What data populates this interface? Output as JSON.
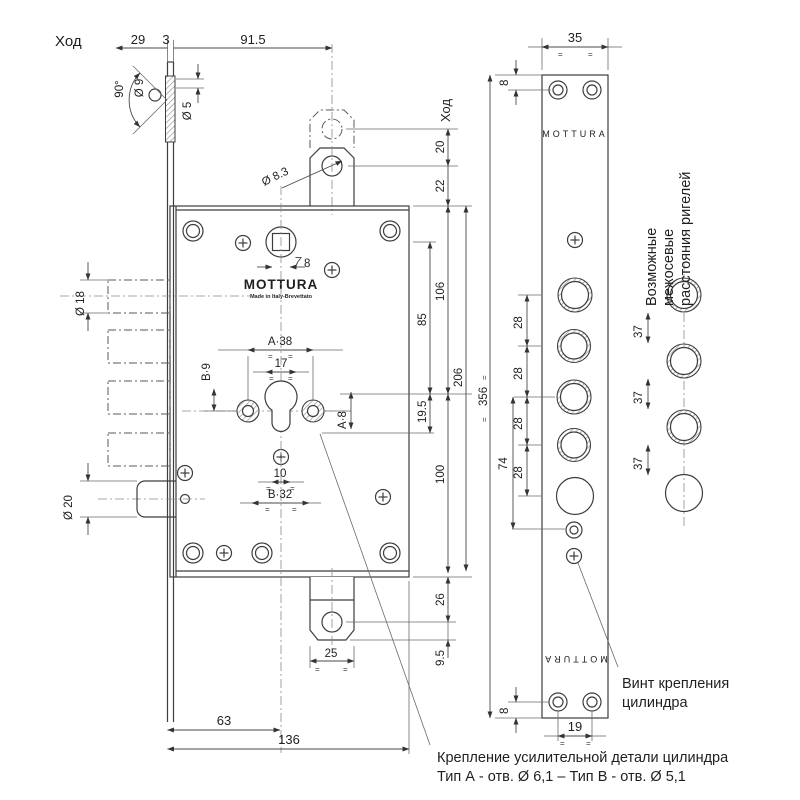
{
  "drawing": {
    "brand": {
      "name": "MOTTURA",
      "sub": "Made in Italy-Brevettato"
    },
    "faceplate": {
      "brand_top": "MOTTURA",
      "brand_bottom": "MOTTURA"
    },
    "labels": {
      "travel_top": "Ход",
      "travel_right": "Ход"
    },
    "dims": {
      "d29": "29",
      "d3": "3",
      "d91_5": "91.5",
      "a90": "90°",
      "dia9": "Ø 9",
      "dia5": "Ø 5",
      "dia8_3": "Ø 8.3",
      "dia18": "Ø 18",
      "dia20": "Ø 20",
      "sq7": "7",
      "sq8": "8",
      "a38": "A·38",
      "d17": "17",
      "b9": "B·9",
      "a8": "A·8",
      "d10": "10",
      "b32": "B·32",
      "d20": "20",
      "d22": "22",
      "d106": "106",
      "d85": "85",
      "d206": "206",
      "d19_5": "19.5",
      "d100": "100",
      "d26": "26",
      "d9_5": "9.5",
      "d25": "25",
      "d63": "63",
      "d136": "136",
      "d35": "35",
      "d8_top": "8",
      "d8_bot": "8",
      "d356": "356",
      "d74": "74",
      "d28": [
        "28",
        "28",
        "28",
        "28"
      ],
      "d19": "19",
      "d37": [
        "37",
        "37",
        "37"
      ],
      "eq": "="
    },
    "notes": {
      "bolt_note": [
        "Возможные",
        "межосевые",
        "расстояния ригелей"
      ],
      "screw_note": [
        "Винт крепления",
        "цилиндра"
      ],
      "reinforce_note": [
        "Крепление усилительной детали цилиндра",
        "Тип А - отв. Ø 6,1 – Тип В - отв. Ø 5,1"
      ]
    }
  }
}
